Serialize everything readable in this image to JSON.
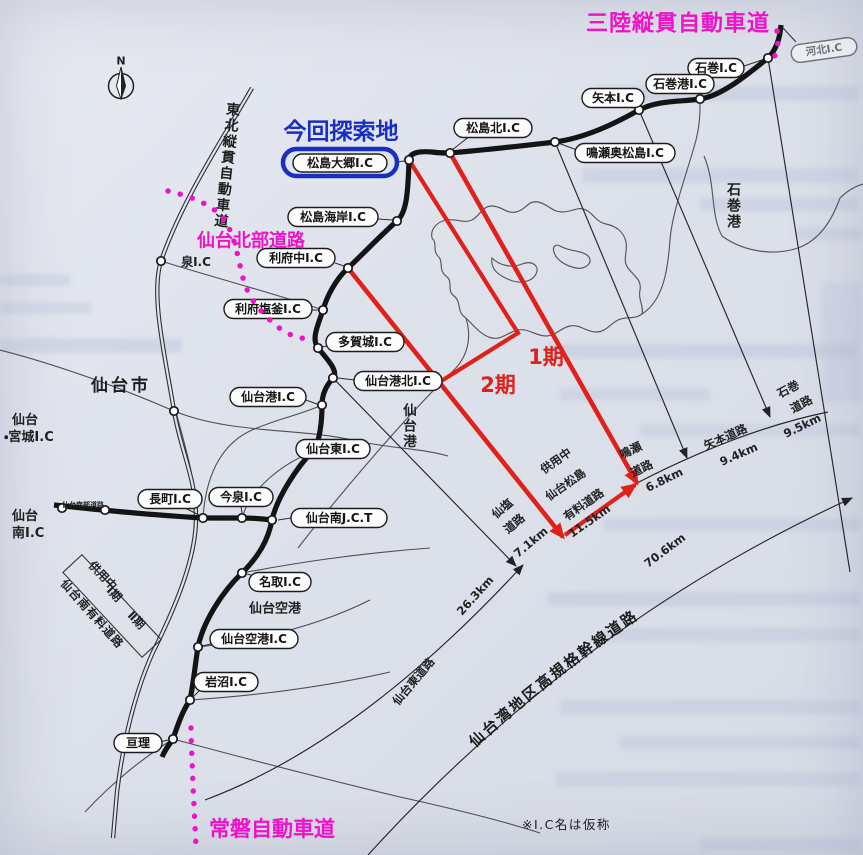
{
  "colors": {
    "magenta": "#ee12c8",
    "blue": "#1b2ec2",
    "red": "#e0201a",
    "ink": "#1c1c1c"
  },
  "compass": {
    "n": "N"
  },
  "annotations": {
    "sanriku": "三陸縦貫自動車道",
    "search": "今回探索地",
    "hokubu": "仙台北部道路",
    "joban": "常磐自動車道",
    "phase1": "1期",
    "phase2": "2期",
    "note": "※I.C名は仮称"
  },
  "ic": [
    "河北I.C",
    "石巻I.C",
    "石巻港I.C",
    "矢本I.C",
    "松島北I.C",
    "鳴瀬奥松島I.C",
    "松島大郷I.C",
    "松島海岸I.C",
    "利府中I.C",
    "利府塩釜I.C",
    "多賀城I.C",
    "仙台港北I.C",
    "仙台港I.C",
    "仙台東I.C",
    "長町I.C",
    "今泉I.C",
    "仙台南J.C.T",
    "名取I.C",
    "仙台空港I.C",
    "岩沼I.C",
    "亘理"
  ],
  "area": {
    "sendai_city": "仙台市",
    "miyagi_l1": "仙台",
    "miyagi_l2": "・宮城I.C",
    "minami_l1": "仙台",
    "minami_l2": "南I.C",
    "izumi": "泉I.C",
    "airport": "仙台空港",
    "sendai_port": "仙台港",
    "ishinomaki_port": "石巻港",
    "tohoku": "東北縦貫自動車道",
    "minor_road": "仙台南部道路"
  },
  "box": {
    "in_service": "供用中",
    "p1": "Ⅰ期",
    "p2": "Ⅱ期",
    "road": "仙台南有料道路"
  },
  "sections": {
    "matsushima": {
      "status": "供用中",
      "l1": "仙台松島",
      "l2": "有料道路",
      "km": "11.5km"
    },
    "senen": {
      "l1": "仙塩",
      "l2": "道路",
      "km": "7.1km"
    },
    "higashi": {
      "name": "仙台東道路",
      "km": "26.3km"
    },
    "naruse": {
      "l1": "鳴瀬",
      "l2": "道路",
      "km": "6.8km"
    },
    "yamoto": {
      "name": "矢本道路",
      "km": "9.4km"
    },
    "ishinomaki": {
      "l1": "石巻",
      "l2": "道路",
      "km": "9.5km"
    },
    "bay": {
      "name": "仙台湾地区高規格幹線道路",
      "km": "70.6km"
    }
  }
}
